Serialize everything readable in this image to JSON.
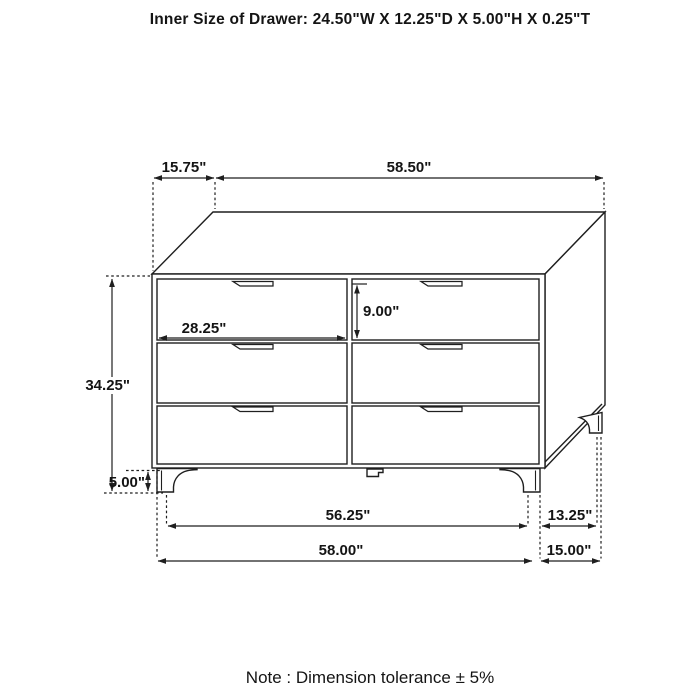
{
  "title": "Inner Size of Drawer: 24.50\"W X 12.25\"D X 5.00\"H X 0.25\"T",
  "note": "Note : Dimension tolerance  ± 5%",
  "colors": {
    "line": "#1f1f1f",
    "background": "#ffffff"
  },
  "structure": {
    "item": "dresser",
    "drawer_rows": 3,
    "drawer_columns": 2,
    "drawer_count": 6,
    "leg_count_visible": 4
  },
  "dimensions": {
    "top_depth": "15.75\"",
    "top_width": "58.50\"",
    "overall_height": "34.25\"",
    "leg_height": "5.00\"",
    "drawer_width": "28.25\"",
    "drawer_height": "9.00\"",
    "front_leg_span": "56.25\"",
    "base_width": "58.00\"",
    "side_leg_span": "13.25\"",
    "base_depth": "15.00\""
  }
}
